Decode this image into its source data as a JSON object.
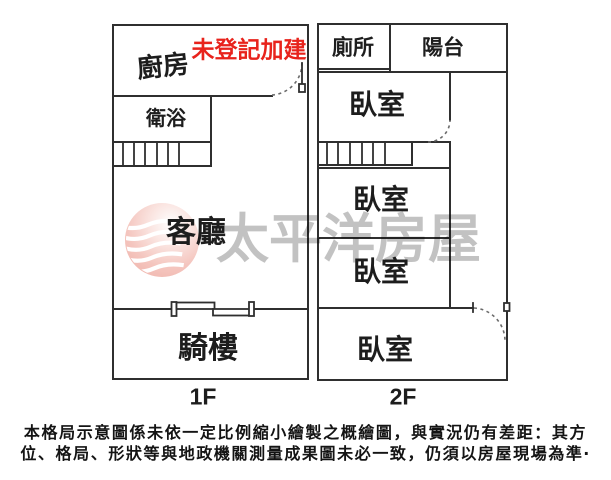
{
  "plan": {
    "floor1": {
      "floor_label": "1F",
      "annotation": "未登記加建",
      "rooms": {
        "kitchen": "廚房",
        "bath": "衛浴",
        "living": "客廳",
        "arcade": "騎樓"
      }
    },
    "floor2": {
      "floor_label": "2F",
      "rooms": {
        "toilet": "廁所",
        "balcony": "陽台",
        "bedroom_top": "臥室",
        "bedroom_mid1": "臥室",
        "bedroom_mid2": "臥室",
        "bedroom_bottom": "臥室"
      }
    }
  },
  "watermark": {
    "text": "太平洋房屋",
    "logo_icon": "pacific-waves-logo"
  },
  "colors": {
    "line": "#2f2f2f",
    "annotation_red": "#e8231c",
    "watermark_gray": "rgba(0,0,0,0.24)",
    "logo_pink": "#f2b3aa"
  },
  "disclaimer": {
    "line1": "本格局示意圖係未依一定比例縮小繪製之概繪圖，與實況仍有差距：其方",
    "line2": "位、格局、形狀等與地政機關測量成果圖未必一致，仍須以房屋現場為準‧"
  }
}
